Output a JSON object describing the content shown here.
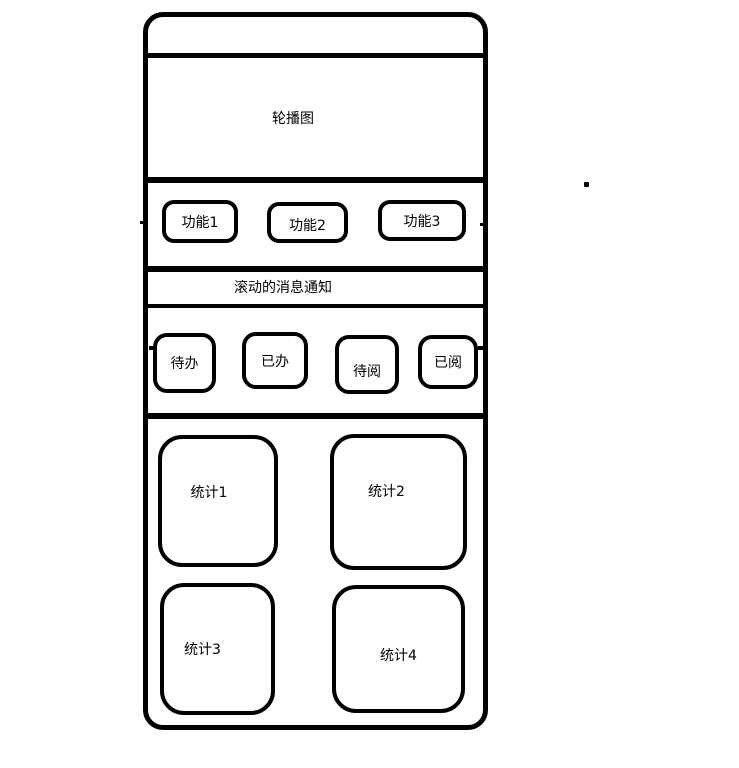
{
  "colors": {
    "stroke": "#000000",
    "background": "#ffffff"
  },
  "phone": {
    "carousel": {
      "label": "轮播图"
    },
    "functions": [
      {
        "label": "功能1"
      },
      {
        "label": "功能2"
      },
      {
        "label": "功能3"
      }
    ],
    "notice": {
      "label": "滚动的消息通知"
    },
    "tasks": [
      {
        "label": "待办"
      },
      {
        "label": "已办"
      },
      {
        "label": "待阅"
      },
      {
        "label": "已阅"
      }
    ],
    "stats": [
      {
        "label": "统计1"
      },
      {
        "label": "统计2"
      },
      {
        "label": "统计3"
      },
      {
        "label": "统计4"
      }
    ]
  }
}
